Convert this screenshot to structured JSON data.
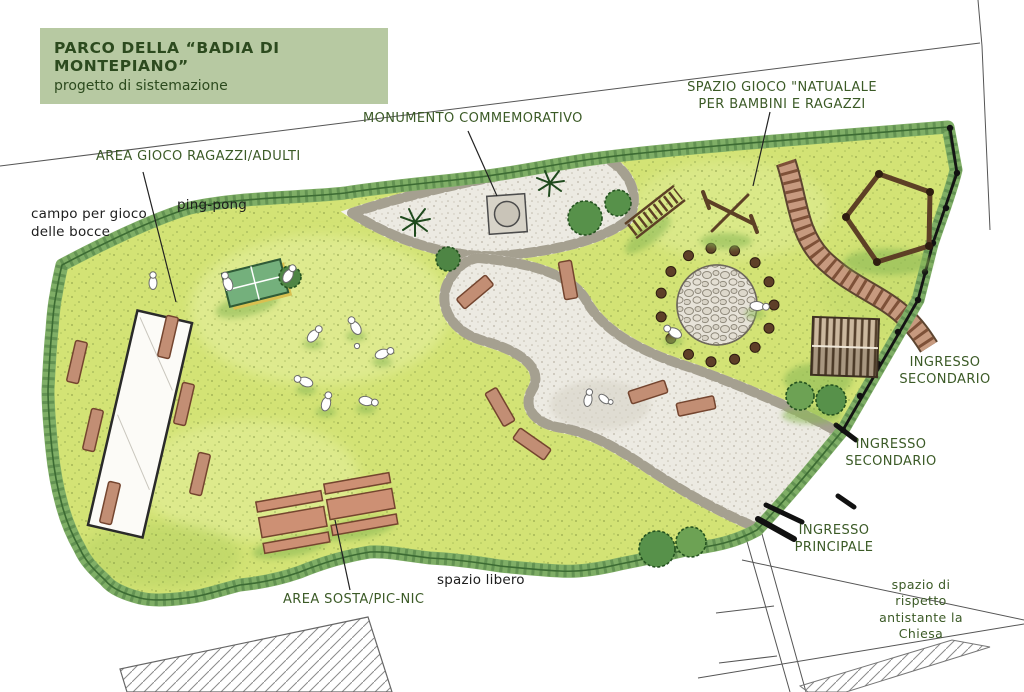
{
  "title_block": {
    "line1": "PARCO DELLA “BADIA DI MONTEPIANO”",
    "line2": "progetto di sistemazione"
  },
  "labels": {
    "spazio_gioco": "SPAZIO GIOCO \"NATUALALE\nPER BAMBINI E RAGAZZI",
    "monumento": "MONUMENTO COMMEMORATIVO",
    "area_gioco": "AREA GIOCO RAGAZZI/ADULTI",
    "ping_pong": "ping-pong",
    "bocce": "campo per gioco\ndelle bocce",
    "ingresso_secondario_1": "INGRESSO\nSECONDARIO",
    "ingresso_secondario_2": "INGRESSO\nSECONDARIO",
    "ingresso_principale": "INGRESSO\nPRINCIPALE",
    "area_sosta": "AREA SOSTA/PIC-NIC",
    "spazio_libero": "spazio libero",
    "spazio_rispetto": "spazio di rispetto\nantistante la Chiesa"
  },
  "colors": {
    "title_bg": "#b7c9a2",
    "label_green": "#3b5a26",
    "label_black": "#1d1d1d",
    "lawn": "#d3e375",
    "hedge": "#7fae66",
    "gravel": "#eceae2",
    "wood_brown": "#5d4026",
    "bench_brown": "#c28e74"
  }
}
